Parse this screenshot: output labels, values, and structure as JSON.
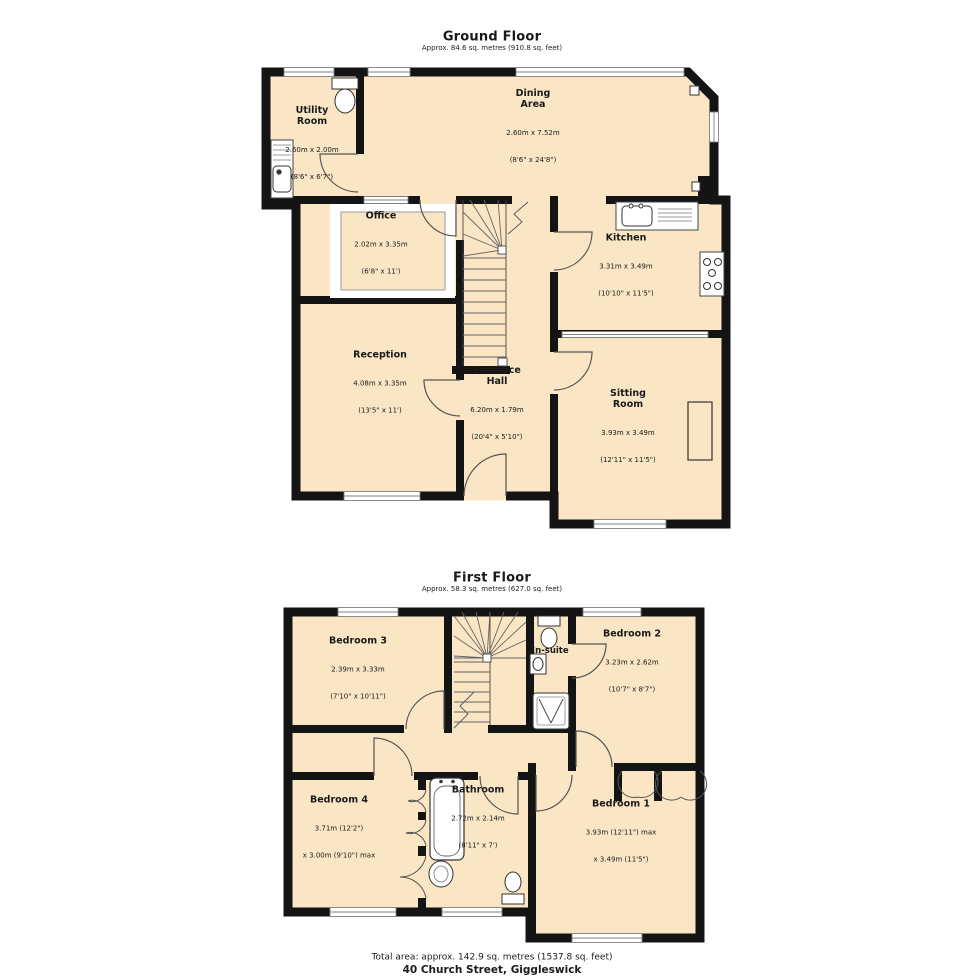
{
  "colors": {
    "floor_fill": "#FAE6C4",
    "wall": "#141414",
    "window_line": "#808080",
    "door_arc": "#555555",
    "text": "#1A1A1A"
  },
  "floors": [
    {
      "title": "Ground Floor",
      "approx": "Approx. 84.6 sq. metres (910.8 sq. feet)",
      "icons": [
        "toilet-icon",
        "utility-sink-icon",
        "kitchen-sink-icon",
        "stove-icon",
        "fireplace",
        "staircase",
        "door-arcs",
        "windows"
      ],
      "rooms": [
        {
          "name": "Utility\nRoom",
          "line1": "2.60m x 2.00m",
          "line2": "(8'6\" x 6'7\")"
        },
        {
          "name": "Dining\nArea",
          "line1": "2.60m x 7.52m",
          "line2": "(8'6\" x 24'8\")"
        },
        {
          "name": "Office",
          "line1": "2.02m x 3.35m",
          "line2": "(6'8\" x 11')"
        },
        {
          "name": "Kitchen",
          "line1": "3.31m x 3.49m",
          "line2": "(10'10\" x 11'5\")"
        },
        {
          "name": "Reception",
          "line1": "4.08m x 3.35m",
          "line2": "(13'5\" x 11')"
        },
        {
          "name": "Entrance\nHall",
          "line1": "6.20m x 1.79m",
          "line2": "(20'4\" x 5'10\")"
        },
        {
          "name": "Sitting\nRoom",
          "line1": "3.93m x 3.49m",
          "line2": "(12'11\" x 11'5\")"
        }
      ]
    },
    {
      "title": "First Floor",
      "approx": "Approx. 58.3 sq. metres (627.0 sq. feet)",
      "icons": [
        "toilet-icon",
        "basin-icon",
        "shower-icon",
        "bathtub-icon",
        "wardrobe-doors",
        "staircase",
        "door-arcs",
        "windows"
      ],
      "rooms": [
        {
          "name": "Bedroom 3",
          "line1": "2.39m x 3.33m",
          "line2": "(7'10\" x 10'11\")"
        },
        {
          "name": "En-suite",
          "line1": "",
          "line2": ""
        },
        {
          "name": "Bedroom 2",
          "line1": "3.23m x 2.62m",
          "line2": "(10'7\" x 8'7\")"
        },
        {
          "name": "Bedroom 4",
          "line1": "3.71m (12'2\")",
          "line2": "x 3.00m (9'10\") max"
        },
        {
          "name": "Bathroom",
          "line1": "2.72m x 2.14m",
          "line2": "(8'11\" x 7')"
        },
        {
          "name": "Bedroom 1",
          "line1": "3.93m (12'11\") max",
          "line2": "x 3.49m (11'5\")"
        }
      ]
    }
  ],
  "footer": {
    "total_area": "Total area: approx. 142.9 sq. metres (1537.8 sq. feet)",
    "address": "40 Church Street, Giggleswick"
  }
}
